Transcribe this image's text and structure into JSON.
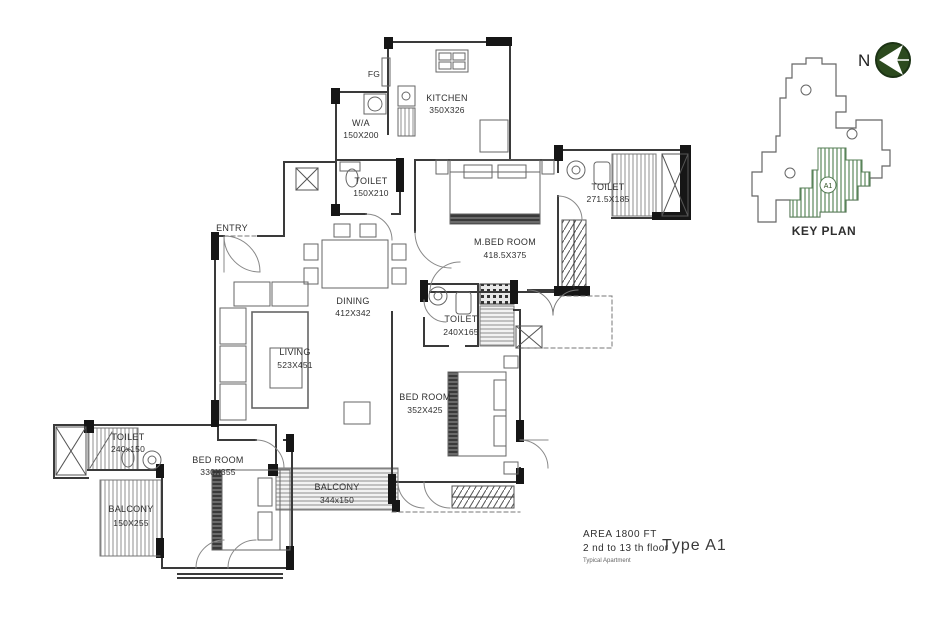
{
  "plan": {
    "labels": {
      "entry": "ENTRY",
      "fg": "FG"
    },
    "rooms": {
      "kitchen": {
        "name": "KITCHEN",
        "dims": "350X326"
      },
      "wa": {
        "name": "W/A",
        "dims": "150X200"
      },
      "toilet_top": {
        "name": "TOILET",
        "dims": "150X210"
      },
      "master_bedroom": {
        "name": "M.BED ROOM",
        "dims": "418.5X375"
      },
      "master_toilet": {
        "name": "TOILET",
        "dims": "271.5X185"
      },
      "dining": {
        "name": "DINING",
        "dims": "412X342"
      },
      "living": {
        "name": "LIVING",
        "dims": "523X451"
      },
      "common_toilet": {
        "name": "TOILET",
        "dims": "240X165"
      },
      "bedroom2": {
        "name": "BED ROOM",
        "dims": "352X425"
      },
      "bedroom3": {
        "name": "BED ROOM",
        "dims": "330X355"
      },
      "toilet3": {
        "name": "TOILET",
        "dims": "240x150"
      },
      "balcony_main": {
        "name": "BALCONY",
        "dims": "344x150"
      },
      "balcony_side": {
        "name": "BALCONY",
        "dims": "150X255"
      }
    }
  },
  "key_plan": {
    "title": "KEY PLAN",
    "north_label": "N",
    "unit": "A1"
  },
  "footer": {
    "area": "AREA 1800 FT",
    "floors": "2 nd to 13 th floor",
    "note": "Typical Apartment",
    "type": "Type A1"
  },
  "colors": {
    "wall": "#2e2e2e",
    "line": "#555555",
    "hatch_gray": "#8f8f8f",
    "keyplan_green": "#5c8a5c",
    "north_green": "#2c4a1e"
  }
}
